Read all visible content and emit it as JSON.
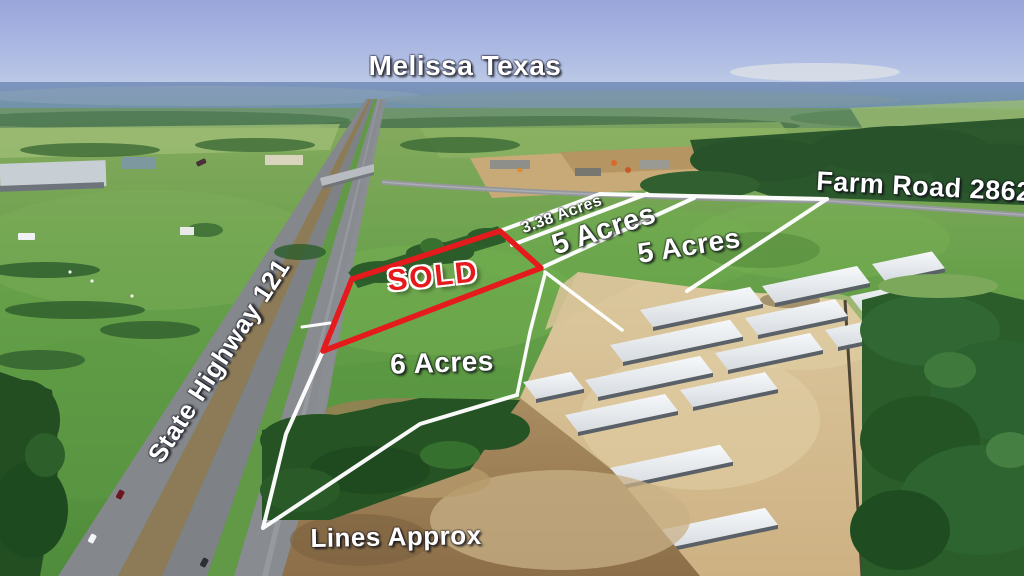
{
  "title": {
    "location": "Melissa Texas"
  },
  "roads": {
    "state_highway": "State Highway 121",
    "farm_road": "Farm Road 2862"
  },
  "parcels": {
    "sold": {
      "status": "SOLD"
    },
    "lot_338": {
      "size": "3.38 Acres"
    },
    "lot_5_front": {
      "size": "5 Acres"
    },
    "lot_5_rear": {
      "size": "5 Acres"
    },
    "lot_6": {
      "size": "6 Acres"
    }
  },
  "footnote": {
    "disclaimer": "Lines Approx"
  },
  "colors": {
    "sold_red": "#e51a1d",
    "parcel_line": "#ffffff",
    "label_text": "#ffffff"
  }
}
